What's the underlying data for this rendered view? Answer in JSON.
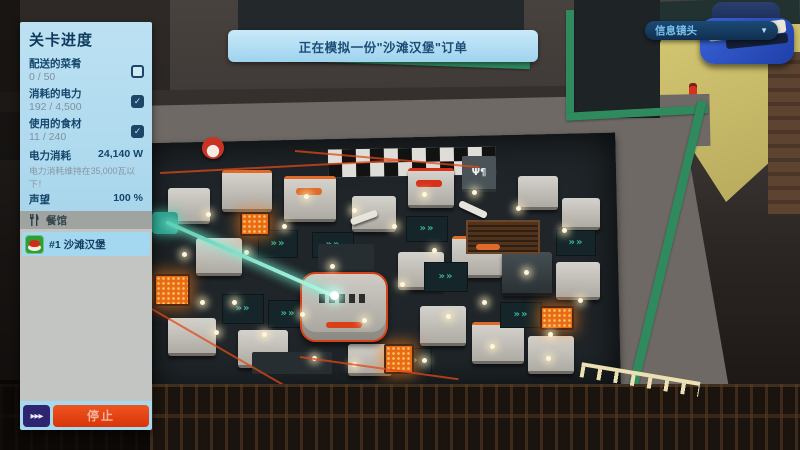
{
  "hud": {
    "level_panel": {
      "title": "关卡进度",
      "objectives": [
        {
          "label": "配送的菜肴",
          "value": "0 / 50",
          "checked": false
        },
        {
          "label": "消耗的电力",
          "value": "192 / 4,500",
          "checked": true
        },
        {
          "label": "使用的食材",
          "value": "11 / 240",
          "checked": true
        }
      ],
      "power_stat": {
        "label": "电力消耗",
        "value": "24,140 W"
      },
      "power_hint": "电力消耗维持在35,000瓦以下！",
      "reputation_stat": {
        "label": "声望",
        "value": "100 %"
      },
      "restaurant_header": "餐馆",
      "orders": [
        {
          "label": "#1 沙滩汉堡"
        }
      ]
    },
    "banner": {
      "text": "正在模拟一份\"沙滩汉堡\"订单"
    },
    "camera_button": {
      "label": "信息镜头"
    }
  },
  "icons": {
    "fast_forward": "▶▶▶",
    "caret_down": "▼",
    "check": "✓",
    "utensils": "fork-and-knife",
    "conveyor_chevrons": "»»",
    "serving_sign": "Ψ¶"
  },
  "colors": {
    "panel_blue": "#b5ddf0",
    "order_highlight_blue": "#a4d8f1",
    "stop_red": "#e2400f",
    "fast_forward_indigo": "#2e2570",
    "camera_pill_navy": "#143a61",
    "roof_trim_green": "#2f8a5e",
    "laser_teal": "#8beed8",
    "banner_blue": "#aed9f0"
  }
}
